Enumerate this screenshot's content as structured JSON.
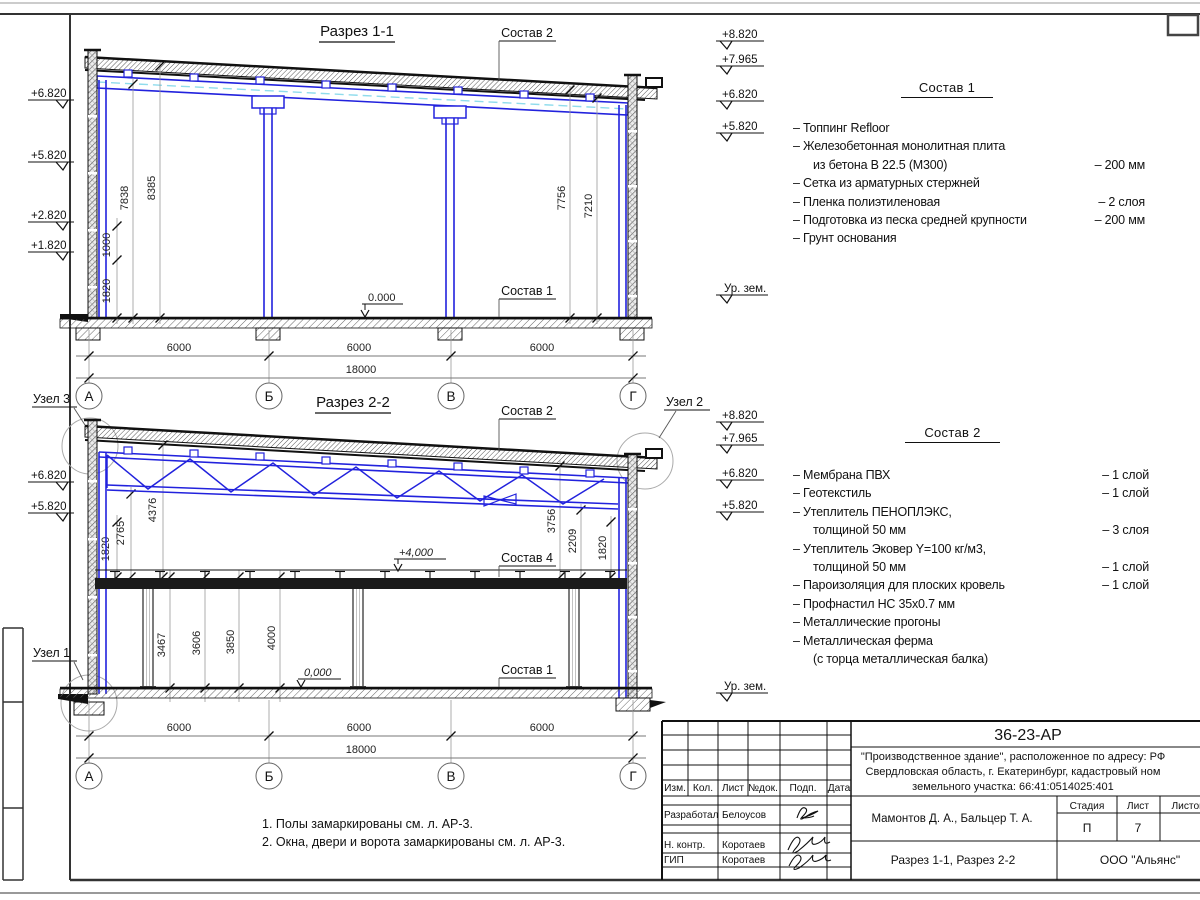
{
  "colors": {
    "structure_blue": "#2222dd",
    "centerline_cyan": "#8fdcec",
    "line": "#1a1a1a"
  },
  "sections": {
    "axes": [
      "А",
      "Б",
      "В",
      "Г"
    ],
    "nodes": {
      "n1": "Узел 1",
      "n2": "Узел 2",
      "n3": "Узел 3"
    },
    "s1": {
      "title": "Разрез 1-1",
      "zero": "0.000",
      "elev_left": [
        "+6.820",
        "+5.820",
        "+2.820",
        "+1.820"
      ],
      "elev_right": [
        "+8.820",
        "+7.965",
        "+6.820",
        "+5.820"
      ],
      "ground_label": "Ур. зем.",
      "dims_v": [
        "7838",
        "8385",
        "1000",
        "1820",
        "7756",
        "7210"
      ],
      "spans": [
        "6000",
        "6000",
        "6000"
      ],
      "total": "18000",
      "label_sostav2": "Состав 2",
      "label_sostav1": "Состав 1"
    },
    "s2": {
      "title": "Разрез 2-2",
      "zero": "0,000",
      "plus4": "+4,000",
      "elev_left": [
        "+6.820",
        "+5.820"
      ],
      "elev_right": [
        "+8.820",
        "+7.965",
        "+6.820",
        "+5.820"
      ],
      "ground_label": "Ур. зем.",
      "dims_left": [
        "1820",
        "2765",
        "4376"
      ],
      "dims_mid": [
        "3467",
        "3606",
        "3850",
        "4000"
      ],
      "dims_right": [
        "3756",
        "2209",
        "1820"
      ],
      "spans": [
        "6000",
        "6000",
        "6000"
      ],
      "total": "18000",
      "label_sostav2": "Состав 2",
      "label_sostav4": "Состав 4",
      "label_sostav1": "Состав 1"
    }
  },
  "sostav1": {
    "title": "Состав 1",
    "lines": [
      {
        "text": "–  Топпинг Refloor",
        "value": ""
      },
      {
        "text": "–  Железобетонная  монолитная плита",
        "value": ""
      },
      {
        "text": "из бетона В 22.5 (М300)",
        "value": "–  200 мм"
      },
      {
        "text": "–  Сетка из арматурных стержней",
        "value": ""
      },
      {
        "text": "–  Пленка полиэтиленовая",
        "value": "–  2 слоя"
      },
      {
        "text": "–  Подготовка из песка средней крупности",
        "value": "–  200 мм"
      },
      {
        "text": "–  Грунт основания",
        "value": ""
      }
    ]
  },
  "sostav2": {
    "title": "Состав 2",
    "lines": [
      {
        "text": "–  Мембрана ПВХ",
        "value": "–  1 слой"
      },
      {
        "text": "–  Геотекстиль",
        "value": "–  1 слой"
      },
      {
        "text": "–  Утеплитель ПЕНОПЛЭКС,",
        "value": ""
      },
      {
        "text": "толщиной 50 мм",
        "value": "–  3 слоя"
      },
      {
        "text": "–  Утеплитель Эковер Y=100 кг/м3,",
        "value": ""
      },
      {
        "text": "толщиной 50 мм",
        "value": "–  1 слой"
      },
      {
        "text": "–  Пароизоляция для плоских кровель",
        "value": "–  1 слой"
      },
      {
        "text": "–  Профнастил НС 35х0.7 мм",
        "value": ""
      },
      {
        "text": "–  Металлические прогоны",
        "value": ""
      },
      {
        "text": "–  Металлическая ферма",
        "value": ""
      },
      {
        "text": "(с торца металлическая балка)",
        "value": ""
      }
    ]
  },
  "notes": [
    "1. Полы замаркированы см. л. АР-3.",
    "2. Окна, двери и ворота замаркированы см. л. АР-3."
  ],
  "titleblock": {
    "doc_code": "36-23-АР",
    "project_line1": "\"Производственное здание\", расположенное по адресу: РФ",
    "project_line2": "Свердловская область, г. Екатеринбург, кадастровый ном",
    "project_line3": "земельного участка: 66:41:0514025:401",
    "col_izm": "Изм.",
    "col_kol": "Кол.",
    "col_list": "Лист",
    "col_ndok": "№док.",
    "col_podp": "Подп.",
    "col_data": "Дата",
    "row1_role": "Разработал",
    "row1_name": "Белоусов",
    "row2_role": "Н. контр.",
    "row2_name": "Коротаев",
    "row3_role": "ГИП",
    "row3_name": "Коротаев",
    "authors": "Мамонтов Д. А., Бальцер Т. А.",
    "stage_label": "Стадия",
    "sheet_label": "Лист",
    "sheets_label": "Листов",
    "stage": "П",
    "sheet_no": "7",
    "drawing_title": "Разрез 1-1, Разрез 2-2",
    "company": "ООО \"Альянс\""
  }
}
